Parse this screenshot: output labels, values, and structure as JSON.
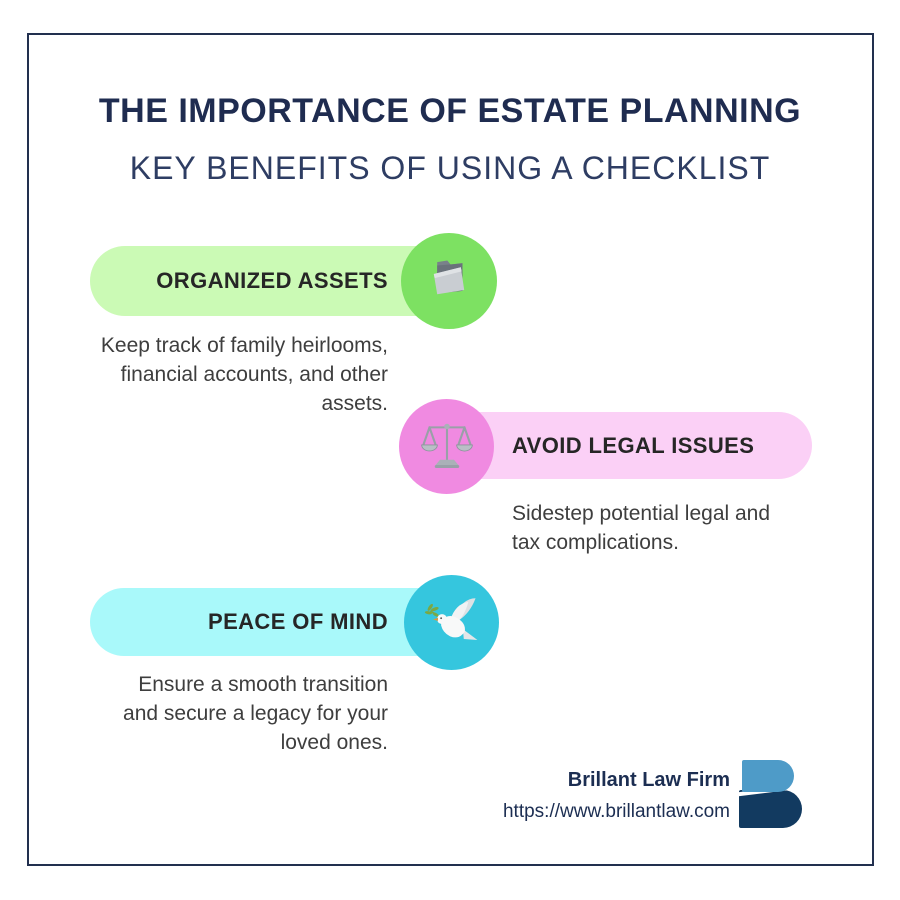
{
  "page": {
    "title": "THE IMPORTANCE OF ESTATE PLANNING",
    "subtitle": "KEY BENEFITS OF USING A CHECKLIST"
  },
  "benefits": [
    {
      "label": "ORGANIZED ASSETS",
      "description": "Keep track of family heirlooms, financial accounts, and other assets.",
      "icon": "folder-icon",
      "pill_color": "#cbfab5",
      "circle_color": "#7de162"
    },
    {
      "label": "AVOID LEGAL ISSUES",
      "description": "Sidestep potential legal and tax complications.",
      "icon": "scales-icon",
      "pill_color": "#fbd0f6",
      "circle_color": "#f08ae1"
    },
    {
      "label": "PEACE OF MIND",
      "description": "Ensure a smooth transition and secure a legacy for your loved ones.",
      "icon": "dove-icon",
      "pill_color": "#a9f9fa",
      "circle_color": "#35c6de"
    }
  ],
  "footer": {
    "company": "Brillant Law Firm",
    "website": "https://www.brillantlaw.com"
  },
  "colors": {
    "title_text": "#1f2c50",
    "subtitle_text": "#2e3d63",
    "frame_border": "#22304f",
    "description_text": "#3e3e3e",
    "label_text": "#262626",
    "footer_text": "#1c2e52",
    "logo_top": "#4e9bc8",
    "logo_bottom": "#123a60"
  }
}
